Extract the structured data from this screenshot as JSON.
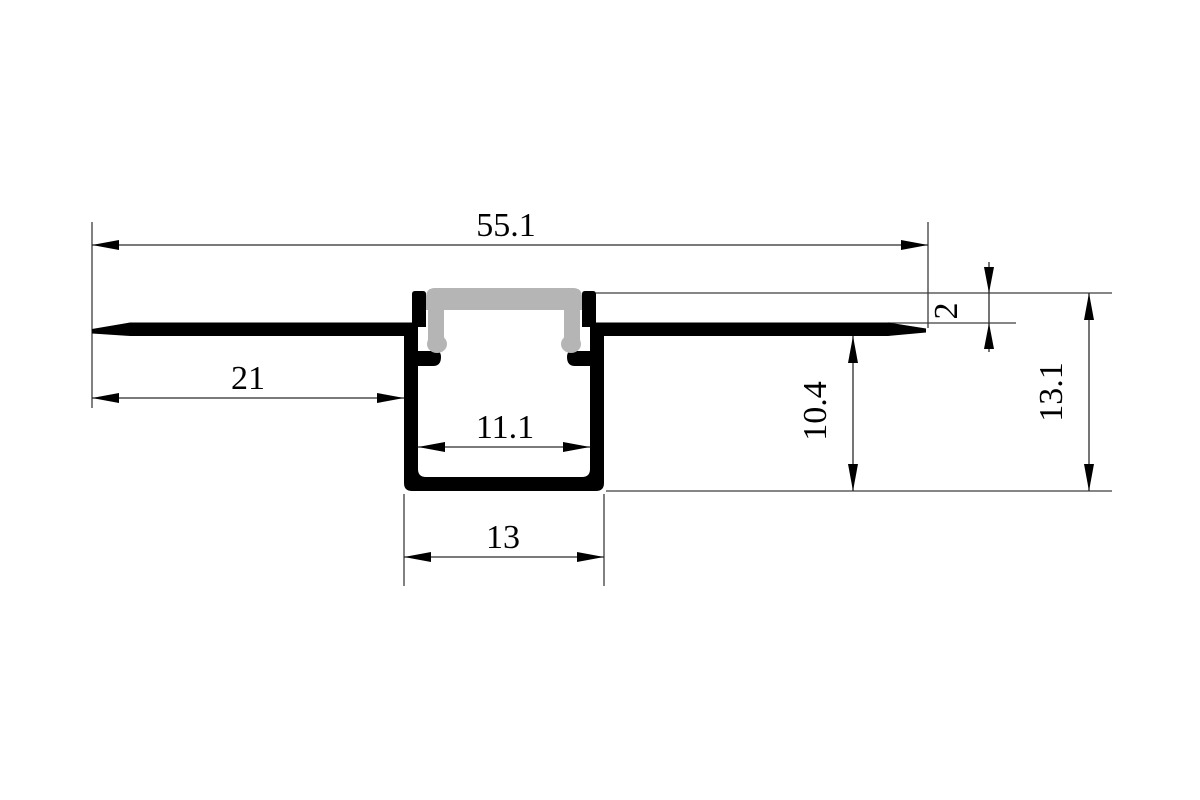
{
  "drawing": {
    "kind": "technical-cross-section",
    "colors": {
      "profile_outline": "#000000",
      "diffuser_cover": "#b5b5b5",
      "dimension_lines": "#3d3d3d",
      "background": "#ffffff"
    },
    "dimensions": {
      "overall_width": "55.1",
      "left_flange_width": "21",
      "inner_width": "11.1",
      "base_width": "13",
      "recess_step": "2",
      "body_depth": "10.4",
      "overall_height": "13.1"
    }
  }
}
